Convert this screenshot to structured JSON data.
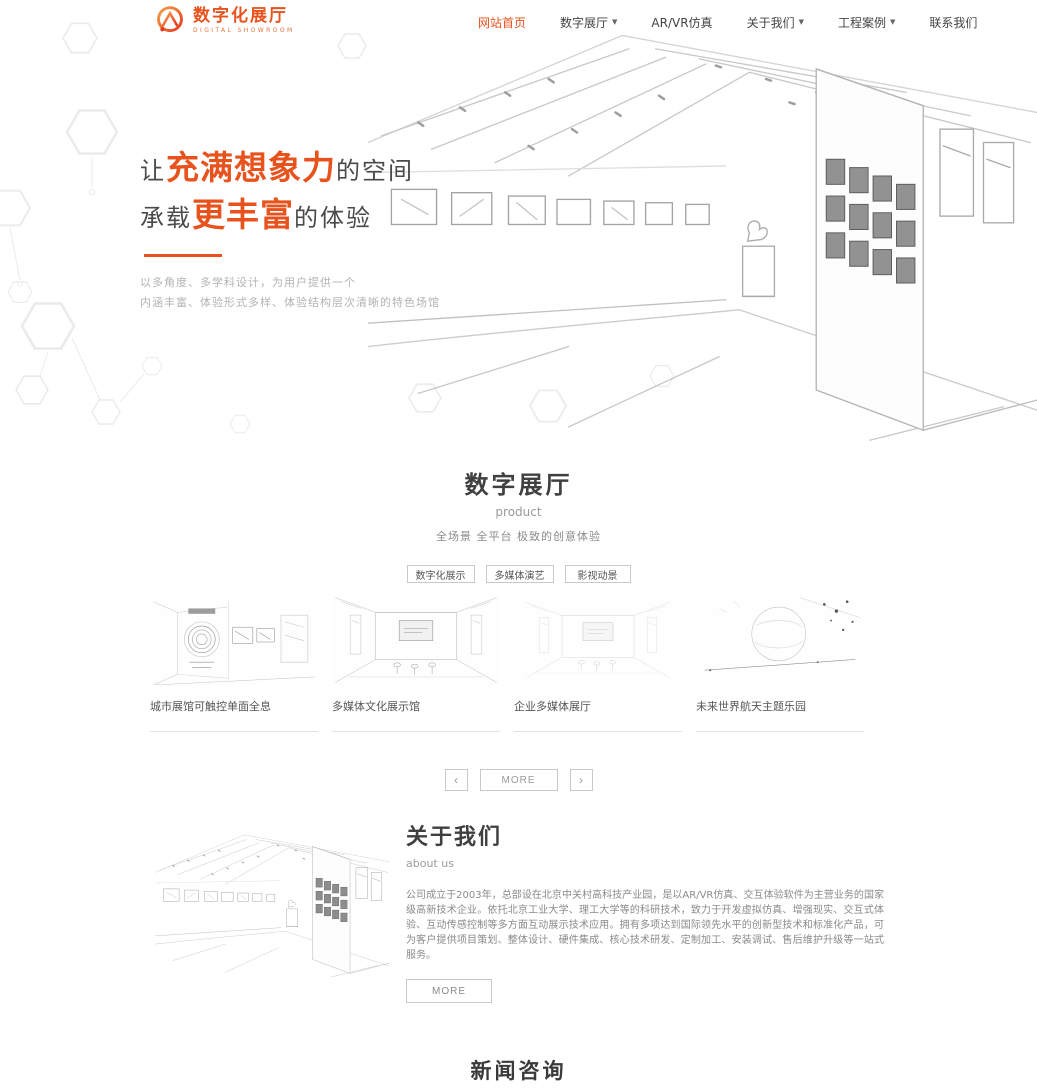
{
  "brand": {
    "name": "数字化展厅",
    "subtitle": "DIGITAL SHOWROOM"
  },
  "icons": {
    "caret": "▼",
    "prev": "‹",
    "next": "›"
  },
  "nav": {
    "items": [
      {
        "label": "网站首页",
        "active": true,
        "dropdown": false
      },
      {
        "label": "数字展厅",
        "active": false,
        "dropdown": true
      },
      {
        "label": "AR/VR仿真",
        "active": false,
        "dropdown": false
      },
      {
        "label": "关于我们",
        "active": false,
        "dropdown": true
      },
      {
        "label": "工程案例",
        "active": false,
        "dropdown": true
      },
      {
        "label": "联系我们",
        "active": false,
        "dropdown": false
      }
    ]
  },
  "hero": {
    "line1_prefix": "让",
    "line1_highlight": "充满想象力",
    "line1_suffix": "的空间",
    "line2_prefix": "承载",
    "line2_highlight": "更丰富",
    "line2_suffix": "的体验",
    "desc1": "以多角度、多学科设计，为用户提供一个",
    "desc2": "内涵丰富、体验形式多样、体验结构层次清晰的特色场馆"
  },
  "products": {
    "title": "数字展厅",
    "subtitle": "product",
    "tagline": "全场景 全平台 极致的创意体验",
    "filters": [
      "数字化展示",
      "多媒体演艺",
      "影视动景"
    ],
    "items": [
      {
        "caption": "城市展馆可触控单面全息"
      },
      {
        "caption": "多媒体文化展示馆"
      },
      {
        "caption": "企业多媒体展厅"
      },
      {
        "caption": "未来世界航天主题乐园"
      }
    ],
    "more_label": "MORE"
  },
  "about": {
    "title": "关于我们",
    "subtitle": "about us",
    "body": "公司成立于2003年，总部设在北京中关村高科技产业园，是以AR/VR仿真、交互体验软件为主营业务的国家级高新技术企业。依托北京工业大学、理工大学等的科研技术，致力于开发虚拟仿真、增强现实、交互式体验、互动传感控制等多方面互动展示技术应用。拥有多项达到国际领先水平的创新型技术和标准化产品，可为客户提供项目策划、整体设计、硬件集成、核心技术研发、定制加工、安装调试、售后维护升级等一站式服务。",
    "more_label": "MORE"
  },
  "news": {
    "title": "新闻咨询"
  },
  "colors": {
    "accent": "#e8521d",
    "text_dark": "#3a3a3a",
    "text_gray": "#999999"
  }
}
